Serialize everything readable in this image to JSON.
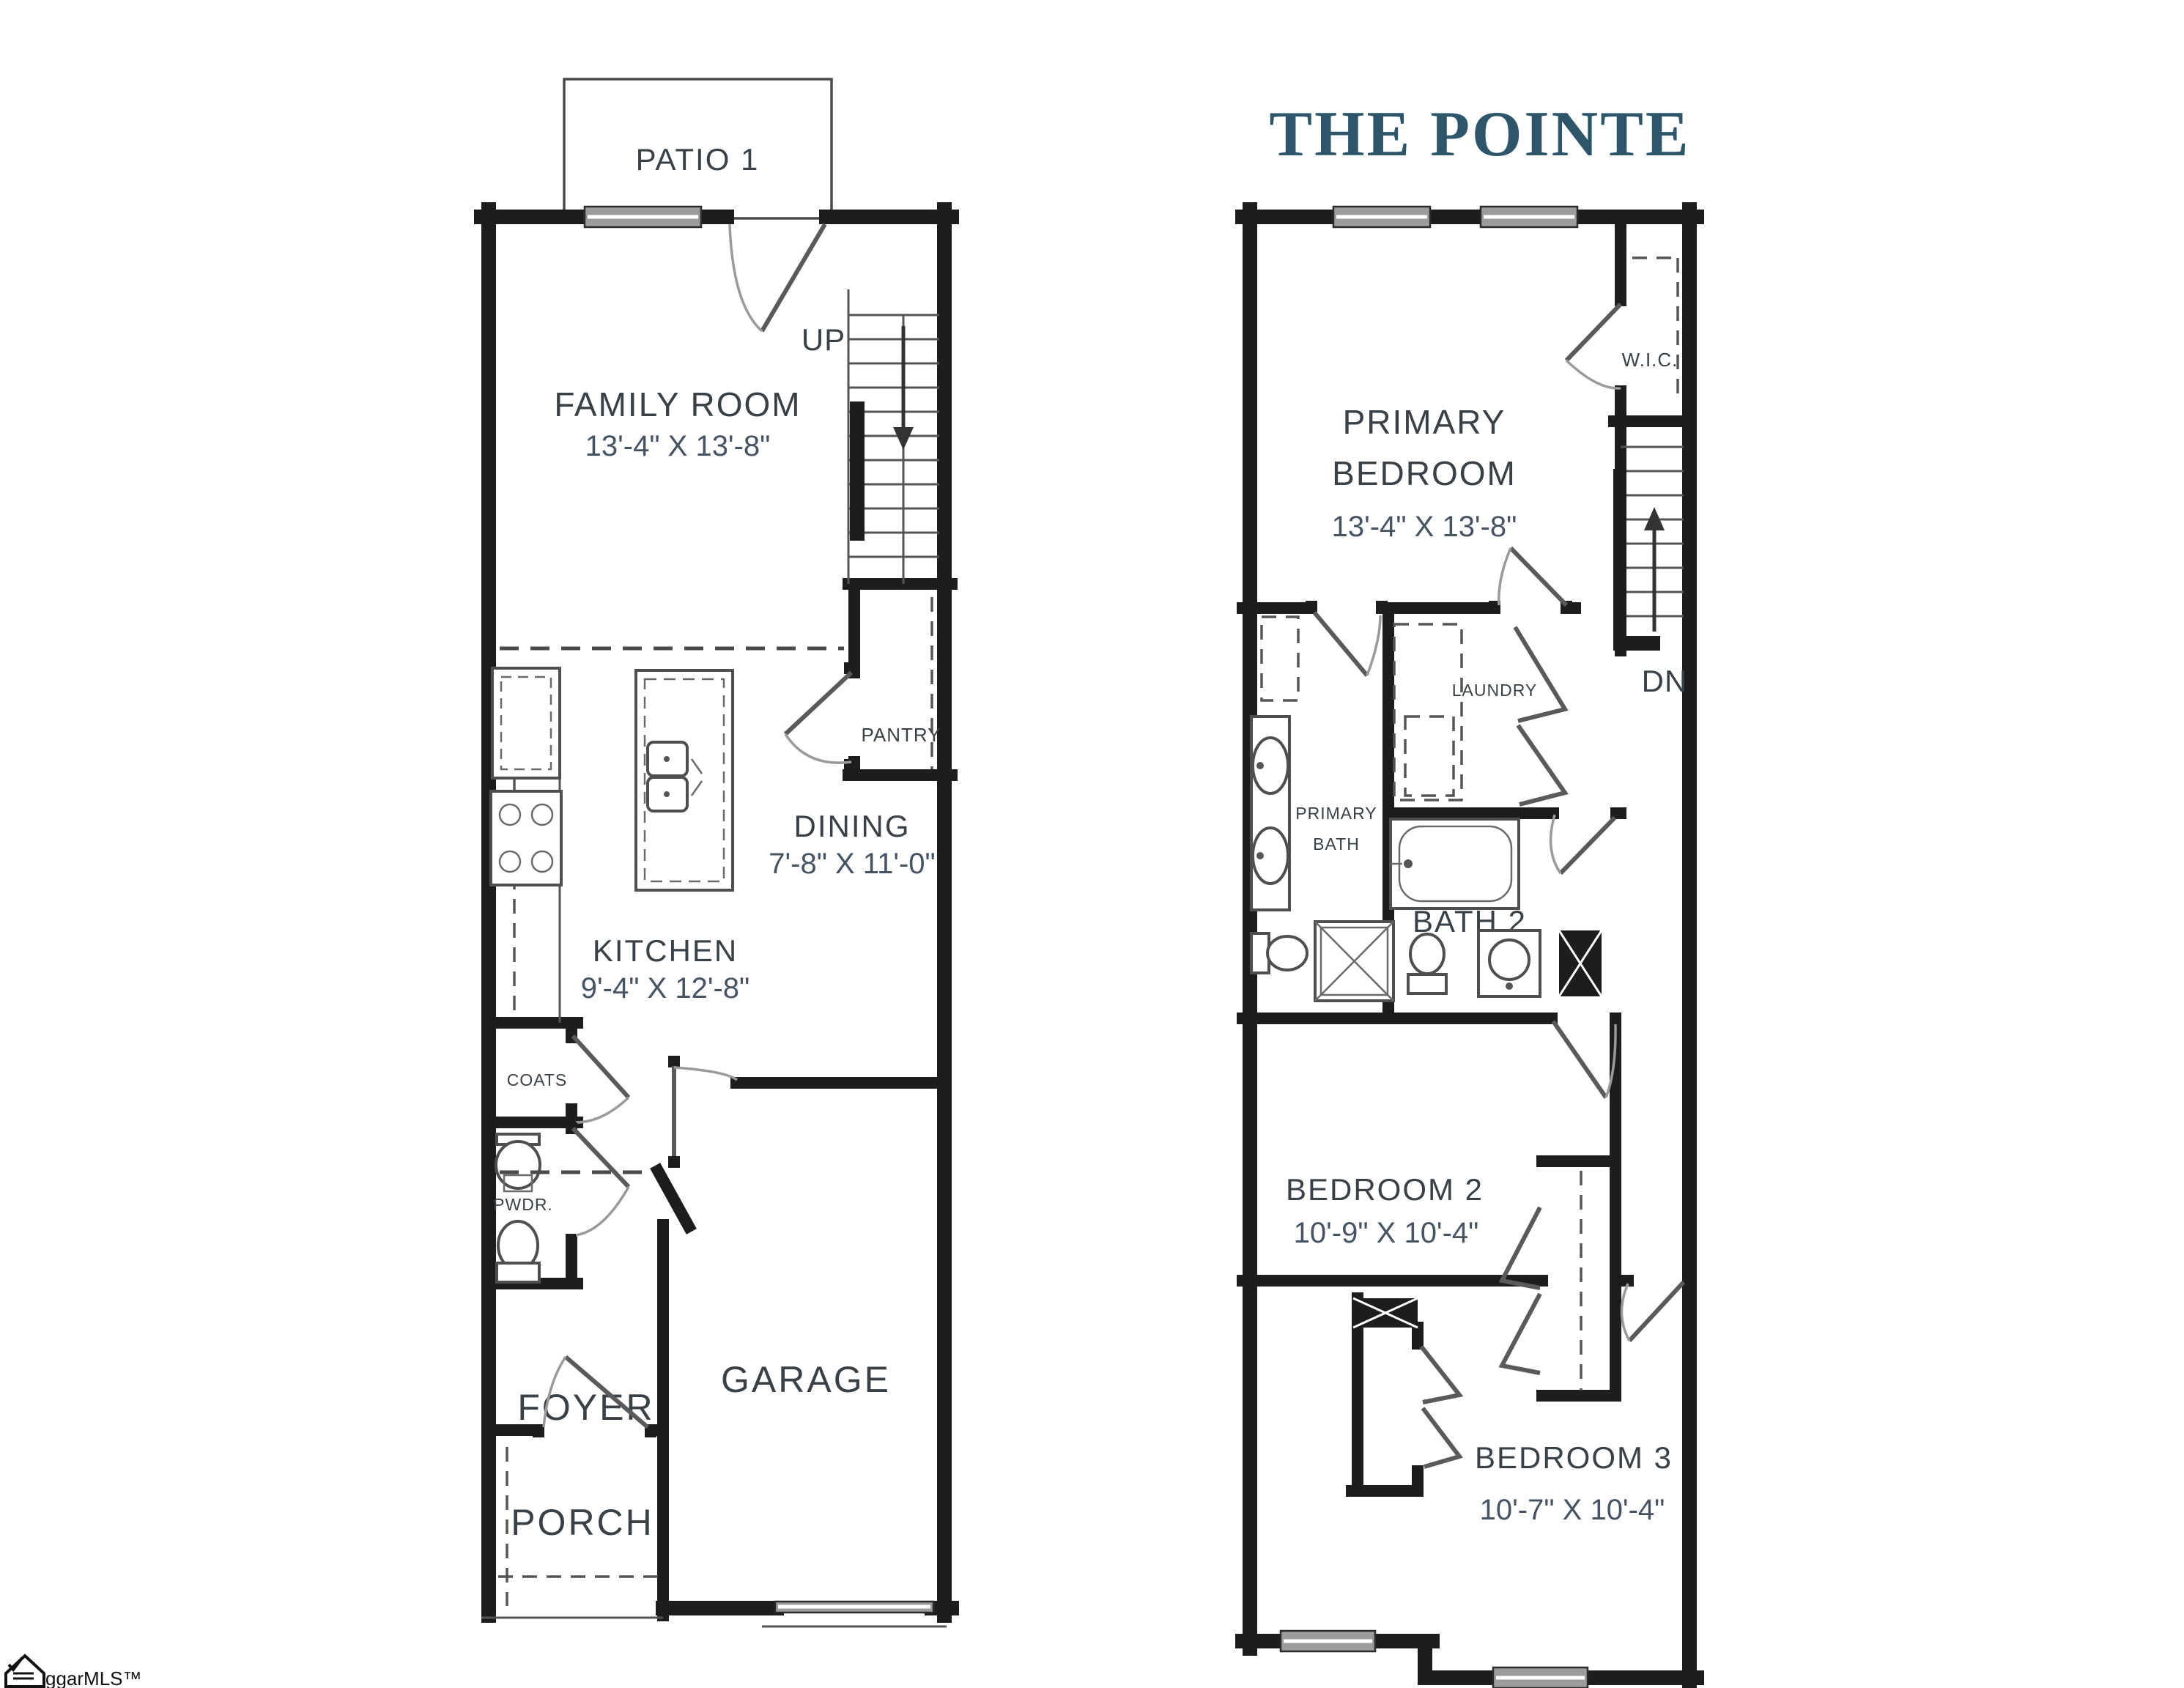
{
  "title": "THE POINTE",
  "watermark": "ggarMLS™",
  "colors": {
    "title": "#2d566b",
    "walls": "#1d1d1d",
    "label": "#3a4146",
    "dims": "#465362",
    "window": "#9c9c9c"
  },
  "first_floor": {
    "patio": "PATIO 1",
    "family_room": {
      "name": "FAMILY ROOM",
      "dims": "13'-4\" X 13'-8\""
    },
    "up": "UP",
    "pantry": "PANTRY",
    "dining": {
      "name": "DINING",
      "dims": "7'-8\" X 11'-0\""
    },
    "kitchen": {
      "name": "KITCHEN",
      "dims": "9'-4\" X 12'-8\""
    },
    "coats": "COATS",
    "powder": "PWDR.",
    "foyer": "FOYER",
    "garage": "GARAGE",
    "porch": "PORCH"
  },
  "second_floor": {
    "primary_bedroom": {
      "line1": "PRIMARY",
      "line2": "BEDROOM",
      "dims": "13'-4\" X 13'-8\""
    },
    "wic": "W.I.C.",
    "dn": "DN",
    "laundry": "LAUNDRY",
    "primary_bath": {
      "line1": "PRIMARY",
      "line2": "BATH"
    },
    "bath2": "BATH 2",
    "bedroom2": {
      "name": "BEDROOM 2",
      "dims": "10'-9\" X 10'-4\""
    },
    "bedroom3": {
      "name": "BEDROOM 3",
      "dims": "10'-7\" X 10'-4\""
    }
  }
}
